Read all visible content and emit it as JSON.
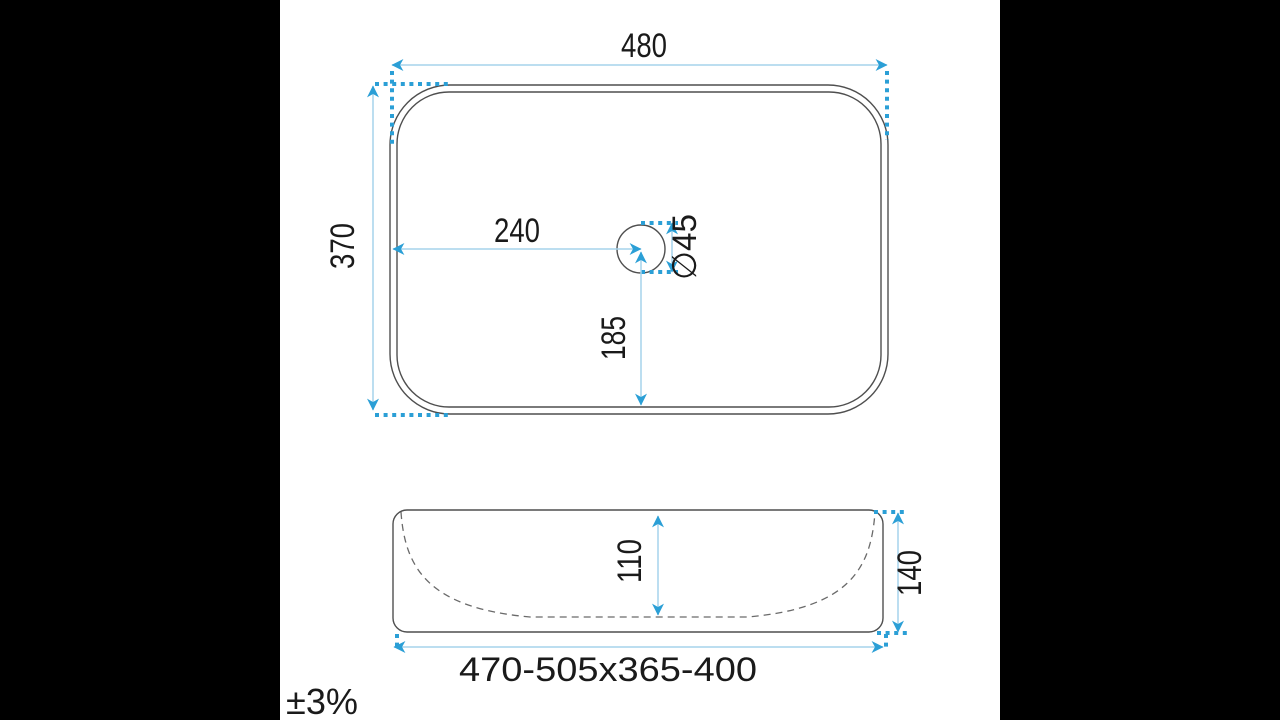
{
  "colors": {
    "letterbox": "#000000",
    "background": "#ffffff",
    "outline": "#4f4f4f",
    "bowl_dash": "#6a6a6a",
    "dim_line": "#a5d3ec",
    "dim_accent": "#2b9fd6",
    "text": "#1a1a1a"
  },
  "views": {
    "top": {
      "dims": {
        "width": {
          "label": "480"
        },
        "depth": {
          "label": "370"
        },
        "drain_offset_x": {
          "label": "240"
        },
        "drain_offset_y": {
          "label": "185"
        },
        "drain_diameter": {
          "label": "∅45"
        }
      }
    },
    "side": {
      "dims": {
        "basin_depth": {
          "label": "110"
        },
        "overall_height": {
          "label": "140"
        },
        "footprint_range": {
          "label": "470-505x365-400"
        }
      }
    }
  },
  "tolerance": {
    "label": "±3%"
  }
}
